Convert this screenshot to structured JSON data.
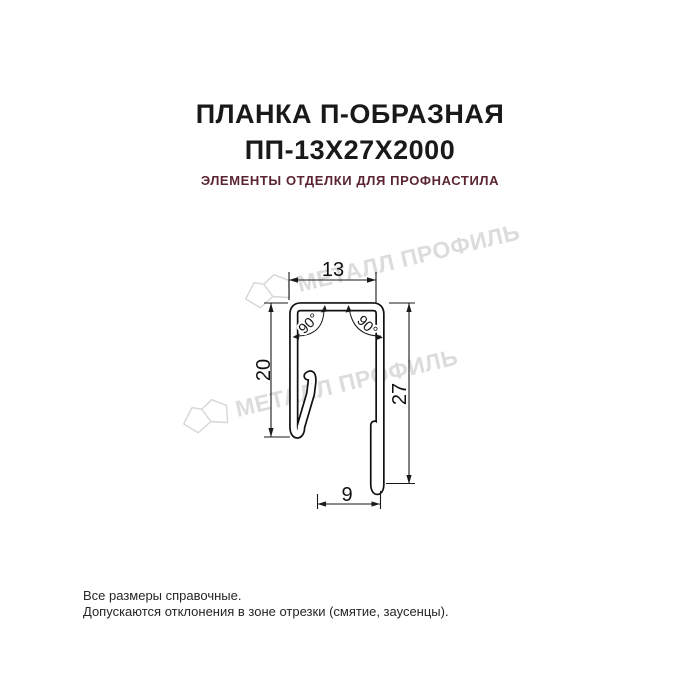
{
  "header": {
    "title_line1": "ПЛАНКА П-ОБРАЗНАЯ",
    "title_line2": "ПП-13Х27Х2000",
    "subtitle": "ЭЛЕМЕНТЫ ОТДЕЛКИ ДЛЯ ПРОФНАСТИЛА",
    "title_color": "#191919",
    "subtitle_color": "#5a2530"
  },
  "drawing": {
    "type": "profile-cross-section",
    "line_color": "#111111",
    "dimensions": {
      "top_width": "13",
      "left_height": "20",
      "right_height": "27",
      "bottom_width": "9",
      "angle_left": "90°",
      "angle_right": "90°"
    }
  },
  "watermark": {
    "text": "МЕТАЛЛ ПРОФИЛЬ",
    "color": "#dcdcdc"
  },
  "footer": {
    "line1": "Все размеры справочные.",
    "line2": "Допускаются отклонения в зоне отрезки (смятие, заусенцы)."
  }
}
